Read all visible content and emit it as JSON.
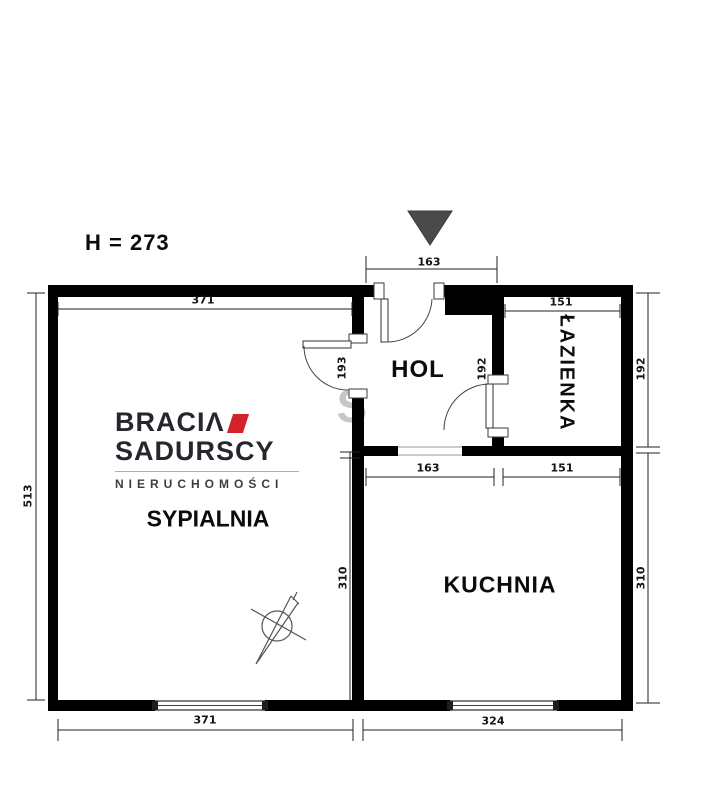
{
  "header": {
    "height_label": "H = 273"
  },
  "watermark": {
    "letter": "S"
  },
  "logo": {
    "brand_top": "BRACIΛ",
    "brand_bottom": "SADURSCY",
    "subtitle": "NIERUCHOMOŚCI",
    "accent_color": "#d2232a"
  },
  "rooms": {
    "bedroom": "SYPIALNIA",
    "hall": "HOL",
    "kitchen": "KUCHNIA",
    "bathroom": "ŁAZIENKA"
  },
  "dims": {
    "entry_door_width": "163",
    "bedroom_width_top": "371",
    "bathroom_width_top": "151",
    "hall_width": "163",
    "bathroom_width_bottom": "151",
    "left_total_height": "513",
    "hall_left_height": "193",
    "hall_right_height": "192",
    "bathroom_height_right": "192",
    "kitchen_height_right": "310",
    "kitchen_height_left": "310",
    "bedroom_width_bottom": "371",
    "kitchen_width_bottom": "324"
  },
  "colors": {
    "wall": "#000000",
    "north_marker": "#4a4a4a",
    "dim_line": "#222222"
  }
}
